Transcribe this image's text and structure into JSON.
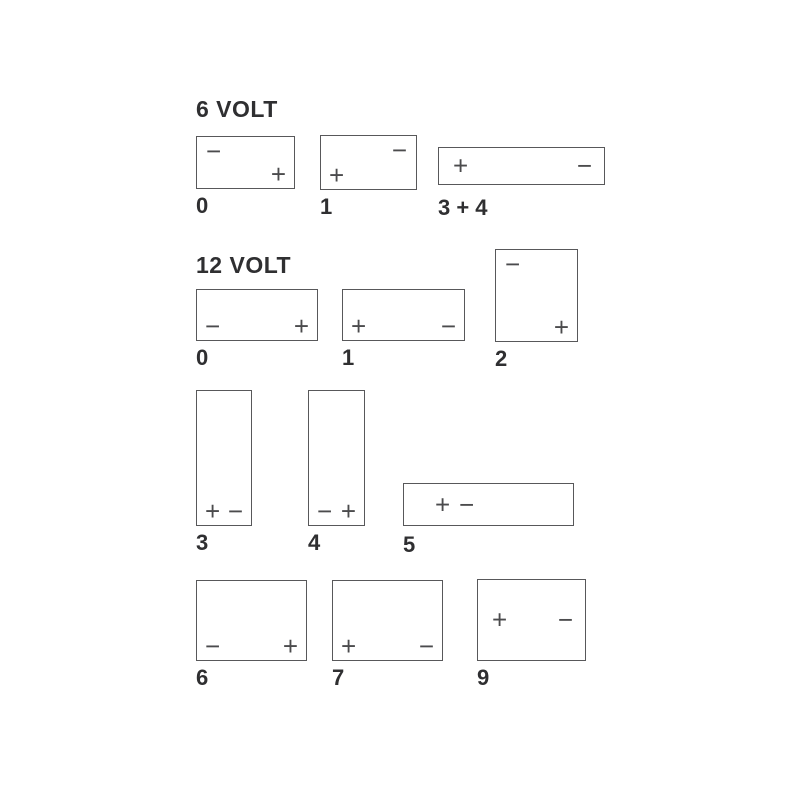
{
  "page": {
    "background": "#ffffff",
    "line_color": "#58585a",
    "text_color": "#2f2f31"
  },
  "icons": {
    "plus": "+",
    "minus": "−"
  },
  "sections": [
    {
      "id": "6v",
      "title": "6 VOLT",
      "boxes": [
        {
          "id": "6v0",
          "label": "0",
          "shape": "wide",
          "terminals": [
            {
              "icon": "minus",
              "pos": "tl"
            },
            {
              "icon": "plus",
              "pos": "br"
            }
          ]
        },
        {
          "id": "6v1",
          "label": "1",
          "shape": "wide",
          "terminals": [
            {
              "icon": "minus",
              "pos": "tr"
            },
            {
              "icon": "plus",
              "pos": "bl"
            }
          ]
        },
        {
          "id": "6v34",
          "label": "3 + 4",
          "shape": "flat-wide",
          "terminals": [
            {
              "icon": "plus",
              "pos": "ml"
            },
            {
              "icon": "minus",
              "pos": "mr"
            }
          ]
        }
      ]
    },
    {
      "id": "12v",
      "title": "12 VOLT",
      "boxes": [
        {
          "id": "12v0",
          "label": "0",
          "shape": "wide",
          "terminals": [
            {
              "icon": "minus",
              "pos": "bl"
            },
            {
              "icon": "plus",
              "pos": "br"
            }
          ]
        },
        {
          "id": "12v1",
          "label": "1",
          "shape": "wide",
          "terminals": [
            {
              "icon": "plus",
              "pos": "bl"
            },
            {
              "icon": "minus",
              "pos": "br"
            }
          ]
        },
        {
          "id": "12v2",
          "label": "2",
          "shape": "tall-square",
          "terminals": [
            {
              "icon": "minus",
              "pos": "tl"
            },
            {
              "icon": "plus",
              "pos": "br"
            }
          ]
        },
        {
          "id": "12v3",
          "label": "3",
          "shape": "tall-narrow",
          "terminals": [
            {
              "icon": "plus",
              "pos": "bl"
            },
            {
              "icon": "minus",
              "pos": "br"
            }
          ]
        },
        {
          "id": "12v4",
          "label": "4",
          "shape": "tall-narrow",
          "terminals": [
            {
              "icon": "minus",
              "pos": "bl"
            },
            {
              "icon": "plus",
              "pos": "br"
            }
          ]
        },
        {
          "id": "12v5",
          "label": "5",
          "shape": "flat-wide",
          "terminals": [
            {
              "icon": "plus",
              "pos": "cl1"
            },
            {
              "icon": "minus",
              "pos": "cl2"
            }
          ]
        },
        {
          "id": "12v6",
          "label": "6",
          "shape": "large",
          "terminals": [
            {
              "icon": "minus",
              "pos": "bl"
            },
            {
              "icon": "plus",
              "pos": "br"
            }
          ]
        },
        {
          "id": "12v7",
          "label": "7",
          "shape": "large",
          "terminals": [
            {
              "icon": "plus",
              "pos": "bl"
            },
            {
              "icon": "minus",
              "pos": "br"
            }
          ]
        },
        {
          "id": "12v9",
          "label": "9",
          "shape": "large",
          "terminals": [
            {
              "icon": "plus",
              "pos": "ml"
            },
            {
              "icon": "minus",
              "pos": "mr"
            }
          ]
        }
      ]
    }
  ]
}
